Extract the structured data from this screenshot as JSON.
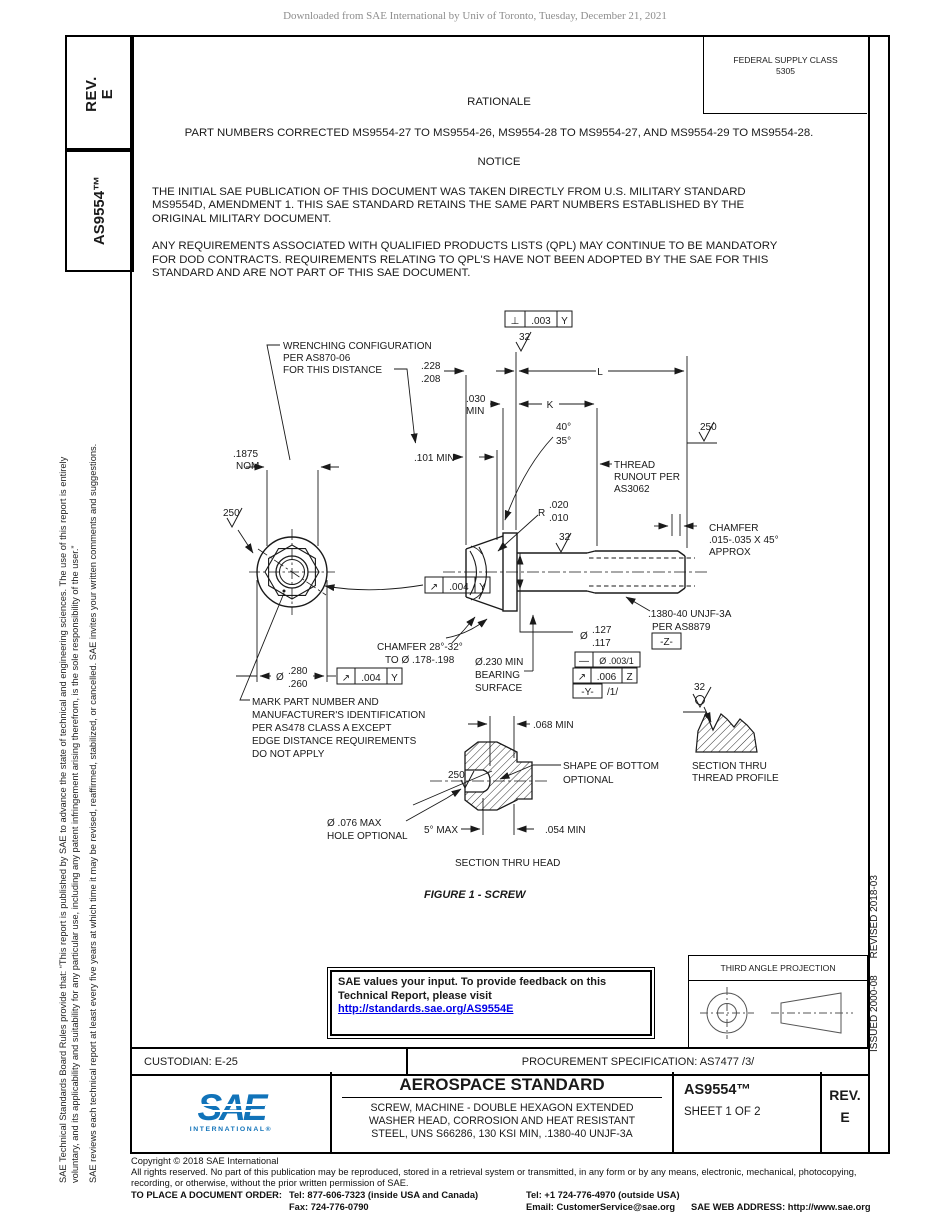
{
  "page": {
    "watermark": "Downloaded from SAE International by Univ of Toronto, Tuesday, December 21, 2021"
  },
  "left_tabs": {
    "rev_label": "REV.",
    "rev_value": "E",
    "doc_number": "AS9554™"
  },
  "left_disclaimer": {
    "line1": "SAE Technical Standards Board Rules provide that: “This report is published by SAE to advance the state of technical and engineering sciences. The use of this report is entirely",
    "line2": "voluntary, and its applicability and suitability for any particular use, including any patent infringement arising therefrom, is the sole responsibility of the user.”",
    "line3": "SAE reviews each technical report at least every five years at which time it may be revised, reaffirmed, stabilized, or cancelled. SAE invites your written comments and suggestions."
  },
  "right_sidebar": {
    "issued": "ISSUED 2000-08",
    "revised": "REVISED 2018-03"
  },
  "header": {
    "fsc_label": "FEDERAL SUPPLY CLASS",
    "fsc_value": "5305"
  },
  "rationale": {
    "title": "RATIONALE",
    "body": "PART NUMBERS CORRECTED MS9554-27 TO MS9554-26, MS9554-28 TO MS9554-27, AND MS9554-29 TO MS9554-28."
  },
  "notice": {
    "title": "NOTICE",
    "p1": [
      "THE INITIAL SAE PUBLICATION OF THIS DOCUMENT WAS TAKEN DIRECTLY FROM U.S. MILITARY STANDARD",
      "MS9554D, AMENDMENT 1. THIS SAE STANDARD RETAINS THE SAME PART NUMBERS ESTABLISHED BY THE",
      "ORIGINAL MILITARY DOCUMENT."
    ],
    "p2": [
      "ANY REQUIREMENTS ASSOCIATED WITH QUALIFIED PRODUCTS LISTS (QPL) MAY CONTINUE TO BE MANDATORY",
      "FOR DOD CONTRACTS. REQUIREMENTS RELATING TO QPL'S HAVE NOT BEEN ADOPTED BY THE SAE FOR THIS",
      "STANDARD AND ARE NOT PART OF THIS SAE DOCUMENT."
    ]
  },
  "figure": {
    "caption": "FIGURE 1 - SCREW",
    "labels": {
      "wrench": [
        "WRENCHING CONFIGURATION",
        "PER AS870-06",
        "FOR THIS DISTANCE"
      ],
      "d228": ".228",
      "d208": ".208",
      "L": "L",
      "K": "K",
      "d030": ".030",
      "min": "MIN",
      "nom_val": ".1875",
      "nom": "NOM",
      "d101": ".101 MIN",
      "a40": "40°",
      "a35": "35°",
      "runout_note": [
        "THREAD",
        "RUNOUT PER",
        "AS3062"
      ],
      "f250": "250",
      "f32": "32",
      "perp_sym": "⊥",
      "perp_val": ".003",
      "perp_datum": "Y",
      "ro_sym": "↗",
      "ro_val": ".004",
      "ro_datum": "Y",
      "r": "R",
      "r020": ".020",
      "r010": ".010",
      "chamfer_note": [
        "CHAMFER",
        ".015-.035 X 45°",
        "APPROX"
      ],
      "thread_note": [
        ".1380-40 UNJF-3A",
        "PER AS8879"
      ],
      "dz": "-Z-",
      "dia": "Ø",
      "d127": ".127",
      "d117": ".117",
      "str_sym": "—",
      "str_val": "Ø .003/1",
      "cir_sym": "↗",
      "cir_val": ".006",
      "cir_datum": "Z",
      "dy": "-Y-",
      "slash1": "/1/",
      "d280": ".280",
      "d260": ".260",
      "cham28_note": [
        "CHAMFER 28°-32°",
        "TO Ø .178-.198"
      ],
      "bearing_note": [
        "Ø.230 MIN",
        "BEARING",
        "SURFACE"
      ],
      "mark_note": [
        "MARK PART NUMBER AND",
        "MANUFACTURER'S IDENTIFICATION",
        "PER AS478 CLASS A EXCEPT",
        "EDGE DISTANCE REQUIREMENTS",
        "DO NOT APPLY"
      ],
      "d068": ".068 MIN",
      "d054": ".054 MIN",
      "shape_note": [
        "SHAPE OF BOTTOM",
        "OPTIONAL"
      ],
      "hole_note": [
        "Ø .076 MAX",
        "HOLE OPTIONAL"
      ],
      "a5": "5° MAX",
      "sec_head": "SECTION THRU HEAD",
      "sec_thread": [
        "SECTION THRU",
        "THREAD PROFILE"
      ]
    }
  },
  "feedback_box": {
    "line1": "SAE values your input. To provide feedback on this",
    "line2": "Technical Report, please visit",
    "link": "http://standards.sae.org/AS9554E"
  },
  "projection": {
    "label": "THIRD ANGLE PROJECTION"
  },
  "info_row": {
    "custodian": "CUSTODIAN: E-25",
    "procurement": "PROCUREMENT SPECIFICATION: AS7477 /3/"
  },
  "title_block": {
    "logo_word": "SAE",
    "logo_sub": "INTERNATIONAL®",
    "heading": "AEROSPACE STANDARD",
    "subtitle": [
      "SCREW, MACHINE - DOUBLE HEXAGON EXTENDED",
      "WASHER HEAD, CORROSION AND HEAT RESISTANT",
      "STEEL, UNS S66286, 130 KSI MIN, .1380-40 UNJF-3A"
    ],
    "doc_number": "AS9554™",
    "sheet": "SHEET 1 OF 2",
    "rev_label": "REV.",
    "rev_value": "E",
    "logo_color": "#1173b9"
  },
  "footer": {
    "copyright": "Copyright © 2018 SAE International",
    "rights1": "All rights reserved. No part of this publication may be reproduced, stored in a retrieval system or transmitted, in any form or by any means, electronic, mechanical, photocopying,",
    "rights2": "recording, or otherwise, without the prior written permission of SAE.",
    "order_label": "TO PLACE A DOCUMENT ORDER:",
    "tel_inside": "Tel: 877-606-7323 (inside USA and Canada)",
    "tel_outside": "Tel: +1 724-776-4970 (outside USA)",
    "fax": "Fax: 724-776-0790",
    "email": "Email: CustomerService@sae.org",
    "web": "SAE WEB ADDRESS: http://www.sae.org"
  }
}
